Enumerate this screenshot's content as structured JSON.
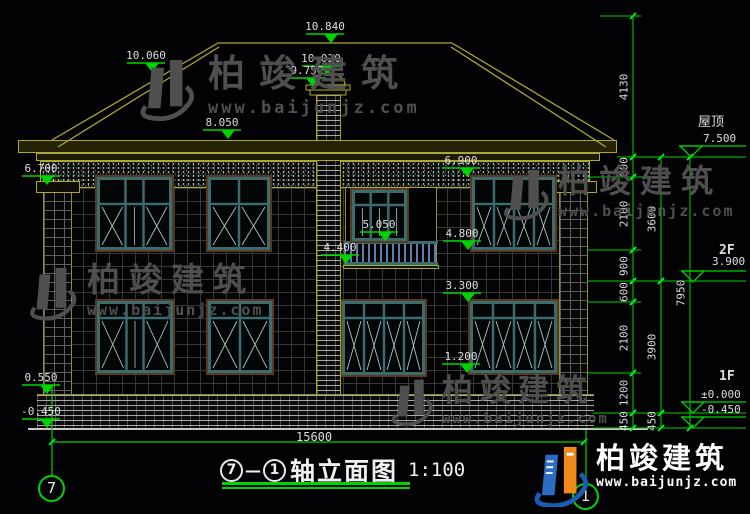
{
  "watermark": {
    "brand": "柏竣建筑",
    "url": "www.baijunjz.com"
  },
  "title": {
    "axis_start": "7",
    "separator": "—",
    "axis_end": "1",
    "name": "轴立面图",
    "scale": "1:100"
  },
  "footer_logo": {
    "brand": "柏竣建筑",
    "url": "www.baijunjz.com"
  },
  "axis_bubbles": [
    {
      "label": "7",
      "cx": 52,
      "cy": 489
    },
    {
      "label": "1",
      "cx": 586,
      "cy": 497
    }
  ],
  "overall_dim": {
    "value": "15600",
    "y": 442,
    "x1": 52,
    "x2": 584
  },
  "markers_filled": [
    {
      "text": "10.840",
      "tipx": 331,
      "tipy": 43
    },
    {
      "text": "10.060",
      "tipx": 152,
      "tipy": 72
    },
    {
      "text": "10.020",
      "tipx": 327,
      "tipy": 75
    },
    {
      "text": "9.750",
      "tipx": 313,
      "tipy": 87
    },
    {
      "text": "8.050",
      "tipx": 228,
      "tipy": 139
    },
    {
      "text": "6.700",
      "tipx": 47,
      "tipy": 185
    },
    {
      "text": "6.900",
      "tipx": 467,
      "tipy": 177
    },
    {
      "text": "5.050",
      "tipx": 385,
      "tipy": 241
    },
    {
      "text": "4.800",
      "tipx": 468,
      "tipy": 250
    },
    {
      "text": "4.400",
      "tipx": 346,
      "tipy": 264
    },
    {
      "text": "3.300",
      "tipx": 468,
      "tipy": 302
    },
    {
      "text": "1.200",
      "tipx": 467,
      "tipy": 373
    },
    {
      "text": "0.550",
      "tipx": 47,
      "tipy": 394
    },
    {
      "text": "-0.450",
      "tipx": 47,
      "tipy": 428
    }
  ],
  "markers_open": [
    {
      "tipx": 691,
      "tipy": 157
    },
    {
      "tipx": 693,
      "tipy": 282
    },
    {
      "tipx": 693,
      "tipy": 413
    },
    {
      "tipx": 693,
      "tipy": 428
    }
  ],
  "side_labels": [
    {
      "text": "屋顶",
      "x": 698,
      "y": 116,
      "cls": "cn"
    },
    {
      "text": "7.500",
      "x": 703,
      "y": 133,
      "cls": "num"
    },
    {
      "text": "2F",
      "x": 719,
      "y": 244,
      "cls": "flr"
    },
    {
      "text": "3.900",
      "x": 712,
      "y": 256,
      "cls": "num"
    },
    {
      "text": "1F",
      "x": 719,
      "y": 370,
      "cls": "flr"
    },
    {
      "text": "±0.000",
      "x": 701,
      "y": 389,
      "cls": "num"
    },
    {
      "text": "-0.450",
      "x": 701,
      "y": 404,
      "cls": "num"
    }
  ],
  "dim_chains": [
    {
      "x": 633,
      "segments": [
        {
          "y1": 16,
          "y2": 157,
          "label": "4130"
        },
        {
          "y1": 157,
          "y2": 177,
          "label": "600"
        },
        {
          "y1": 177,
          "y2": 250,
          "label": "2100"
        },
        {
          "y1": 250,
          "y2": 281,
          "label": "900"
        },
        {
          "y1": 281,
          "y2": 302,
          "label": "600"
        },
        {
          "y1": 302,
          "y2": 373,
          "label": "2100"
        },
        {
          "y1": 373,
          "y2": 413,
          "label": "1200"
        },
        {
          "y1": 413,
          "y2": 428,
          "label": "450"
        }
      ]
    },
    {
      "x": 661,
      "segments": [
        {
          "y1": 157,
          "y2": 281,
          "label": "3600"
        },
        {
          "y1": 281,
          "y2": 413,
          "label": "3900"
        },
        {
          "y1": 413,
          "y2": 428,
          "label": "450"
        }
      ]
    },
    {
      "x": 690,
      "segments": [
        {
          "y1": 157,
          "y2": 428,
          "label": "7950"
        }
      ]
    }
  ],
  "connectors": [
    {
      "y": 16,
      "x1": 600,
      "x2": 641
    },
    {
      "y": 157,
      "x1": 617,
      "x2": 746
    },
    {
      "y": 177,
      "x1": 588,
      "x2": 669
    },
    {
      "y": 250,
      "x1": 588,
      "x2": 641
    },
    {
      "y": 281,
      "x1": 588,
      "x2": 746
    },
    {
      "y": 302,
      "x1": 588,
      "x2": 641
    },
    {
      "y": 373,
      "x1": 588,
      "x2": 641
    },
    {
      "y": 413,
      "x1": 593,
      "x2": 746
    },
    {
      "y": 428,
      "x1": 593,
      "x2": 746
    }
  ],
  "roof_lines": [
    [
      218,
      43,
      452,
      43
    ],
    [
      218,
      43,
      52,
      140
    ],
    [
      219,
      47,
      58,
      147
    ],
    [
      452,
      43,
      614,
      140
    ],
    [
      451,
      47,
      606,
      147
    ]
  ],
  "windows": [
    {
      "x": 97,
      "y": 177,
      "w": 75,
      "h": 73,
      "transom": 27,
      "cols": [
        28,
        19,
        28
      ],
      "xcols": [
        true,
        false,
        true
      ]
    },
    {
      "x": 208,
      "y": 177,
      "w": 62,
      "h": 73,
      "transom": 27,
      "cols": [
        31,
        31
      ],
      "xcols": [
        true,
        true
      ]
    },
    {
      "x": 352,
      "y": 190,
      "w": 55,
      "h": 51,
      "transom": 15,
      "cols": [
        18,
        19,
        18
      ],
      "xcols": [
        false,
        false,
        false
      ]
    },
    {
      "x": 472,
      "y": 177,
      "w": 83,
      "h": 73,
      "transom": 27,
      "cols": [
        21,
        21,
        21,
        20
      ],
      "xcols": [
        true,
        true,
        true,
        true
      ]
    },
    {
      "x": 97,
      "y": 301,
      "w": 76,
      "h": 72,
      "transom": 17,
      "cols": [
        29,
        18,
        29
      ],
      "xcols": [
        true,
        false,
        true
      ]
    },
    {
      "x": 208,
      "y": 301,
      "w": 64,
      "h": 72,
      "transom": 17,
      "cols": [
        32,
        32
      ],
      "xcols": [
        true,
        true
      ]
    },
    {
      "x": 342,
      "y": 301,
      "w": 83,
      "h": 74,
      "transom": 17,
      "cols": [
        21,
        21,
        21,
        20
      ],
      "xcols": [
        true,
        true,
        true,
        true
      ]
    },
    {
      "x": 470,
      "y": 301,
      "w": 87,
      "h": 72,
      "transom": 17,
      "cols": [
        22,
        22,
        22,
        21
      ],
      "xcols": [
        true,
        true,
        true,
        true
      ]
    }
  ],
  "colors": {
    "dim_green": "#00d400",
    "tick_green": "#00ff2a",
    "roof_olive": "#a8a832",
    "text": "#dedede",
    "frame_teal": "#3c6b6e",
    "diag": "#a9c4c4",
    "sill_brown": "#5a3a1e",
    "railing_blue": "#5b7fae",
    "watermark_gray": "#4f4f4f",
    "logo_blue": "#1b5cb4",
    "logo_orange": "#ef8a1a",
    "ground": "#c8c8c8"
  }
}
